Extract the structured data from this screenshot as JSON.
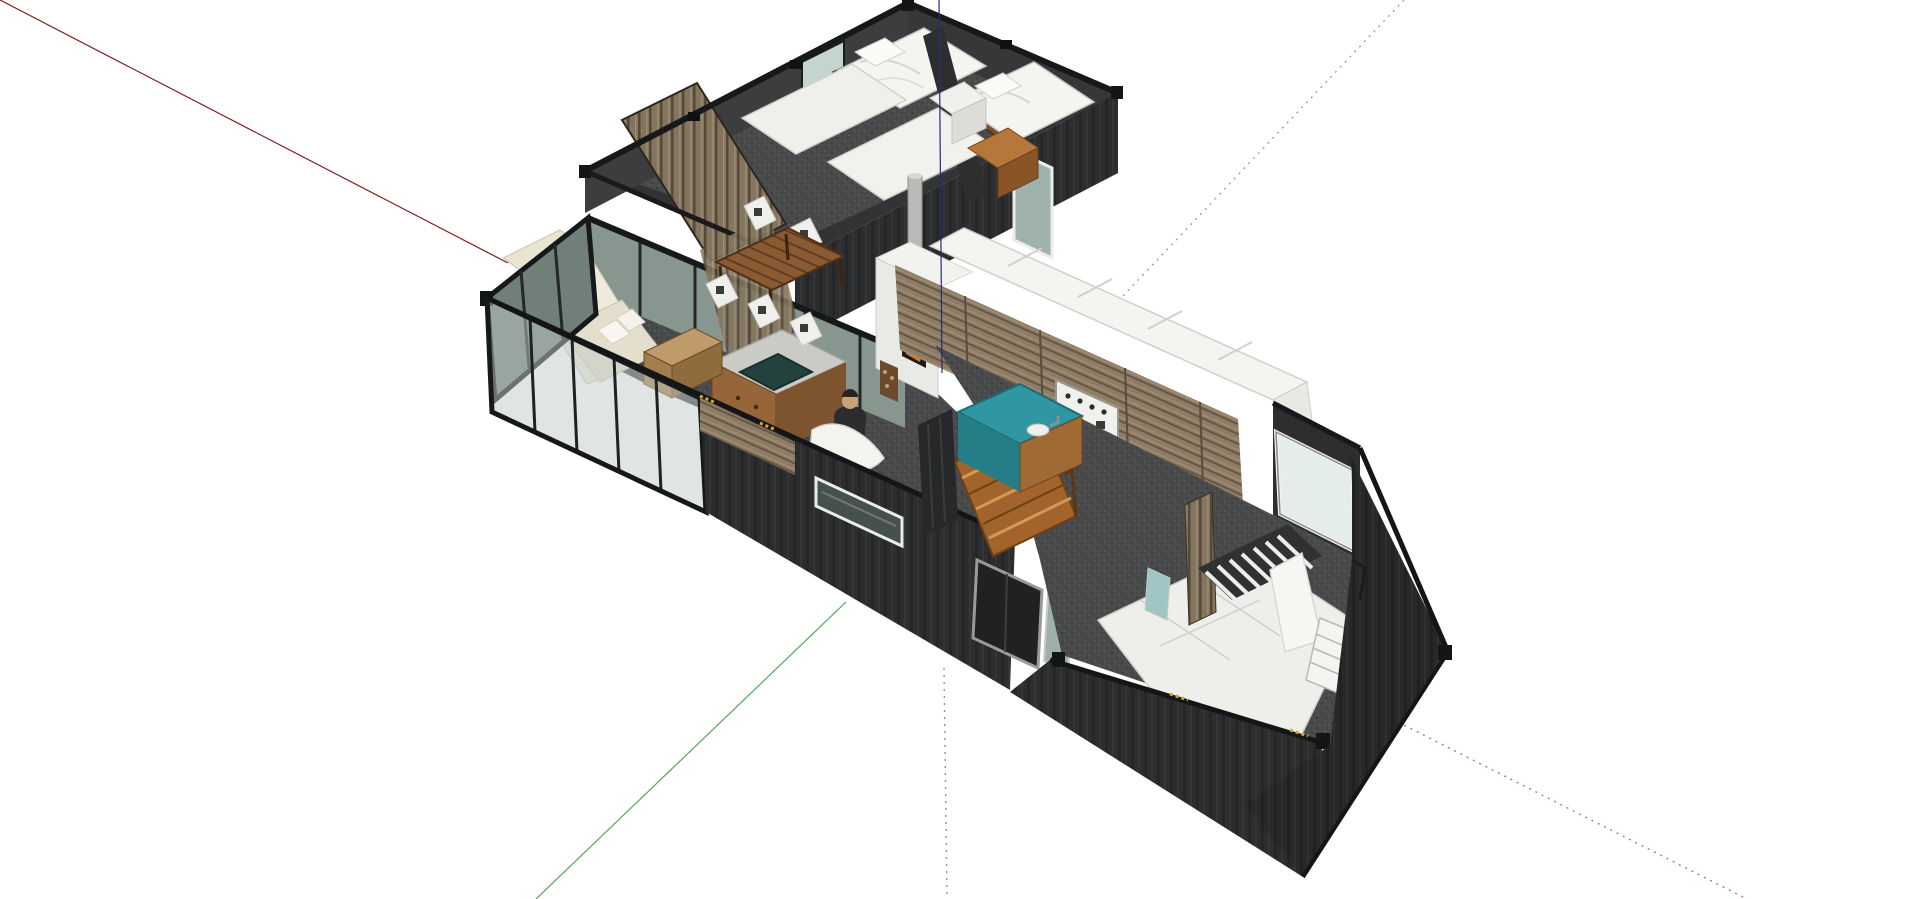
{
  "scene": {
    "app": "3d-modeling-viewport",
    "background": "#ffffff",
    "model_name": "shipping-container-house-floorplan",
    "view": "isometric-top-down-cutaway",
    "rooms": [
      "bedroom-1",
      "bedroom-2",
      "dining-area",
      "living-room",
      "kitchen",
      "stairwell",
      "master-bedroom",
      "entry"
    ],
    "palette": {
      "container_wall": "#2b2d2e",
      "container_rail": "#17181a",
      "carpet": "#494a4b",
      "glass_front": "#c2ccc8",
      "glass_dark": "#708079",
      "glass_inner": "#87968e",
      "window_pale": "#e4edeb",
      "wood_slat_wall": "#84755e",
      "kitchen_wood": "#8d7c66",
      "table_wood": "#8a5a33",
      "stair_wood": "#a2642a",
      "island_teal": "#2f96a2",
      "island_concrete": "#cbcbc6",
      "basin_dark": "#23413d",
      "sofa_cream": "#eae6d6",
      "duvet_white": "#f5f4f0",
      "cabinet_white": "#f4f4f1",
      "fire_orange": "#e07722",
      "flue_gray": "#b9b9b6",
      "hazard_yellow": "#d9a92c"
    }
  },
  "axes": {
    "segments": [
      {
        "name": "red-axis-solid",
        "color": "#801d1d",
        "dash": "none",
        "width": 1.2,
        "x1": 0,
        "y1": 0,
        "x2": 508,
        "y2": 263,
        "layer": "behind"
      },
      {
        "name": "green-axis-solid",
        "color": "#55a559",
        "dash": "none",
        "width": 1.2,
        "x1": 846,
        "y1": 602,
        "x2": 536,
        "y2": 899,
        "layer": "behind"
      },
      {
        "name": "green-axis-dotted",
        "color": "#93a793",
        "dash": "2 5",
        "width": 1.4,
        "x1": 1404,
        "y1": 0,
        "x2": 1123,
        "y2": 296,
        "layer": "behind"
      },
      {
        "name": "blue-axis-dotted",
        "color": "#8f8fa8",
        "dash": "2 5",
        "width": 1.4,
        "x1": 944,
        "y1": 668,
        "x2": 947,
        "y2": 899,
        "layer": "behind"
      },
      {
        "name": "red-axis-dotted",
        "color": "#ad7a72",
        "dash": "2 5",
        "width": 1.4,
        "x1": 1398,
        "y1": 722,
        "x2": 1747,
        "y2": 899,
        "layer": "behind"
      },
      {
        "name": "blue-axis-solid",
        "color": "#2a2a7e",
        "dash": "none",
        "width": 1.2,
        "x1": 939,
        "y1": 0,
        "x2": 942,
        "y2": 373,
        "layer": "front"
      }
    ]
  }
}
